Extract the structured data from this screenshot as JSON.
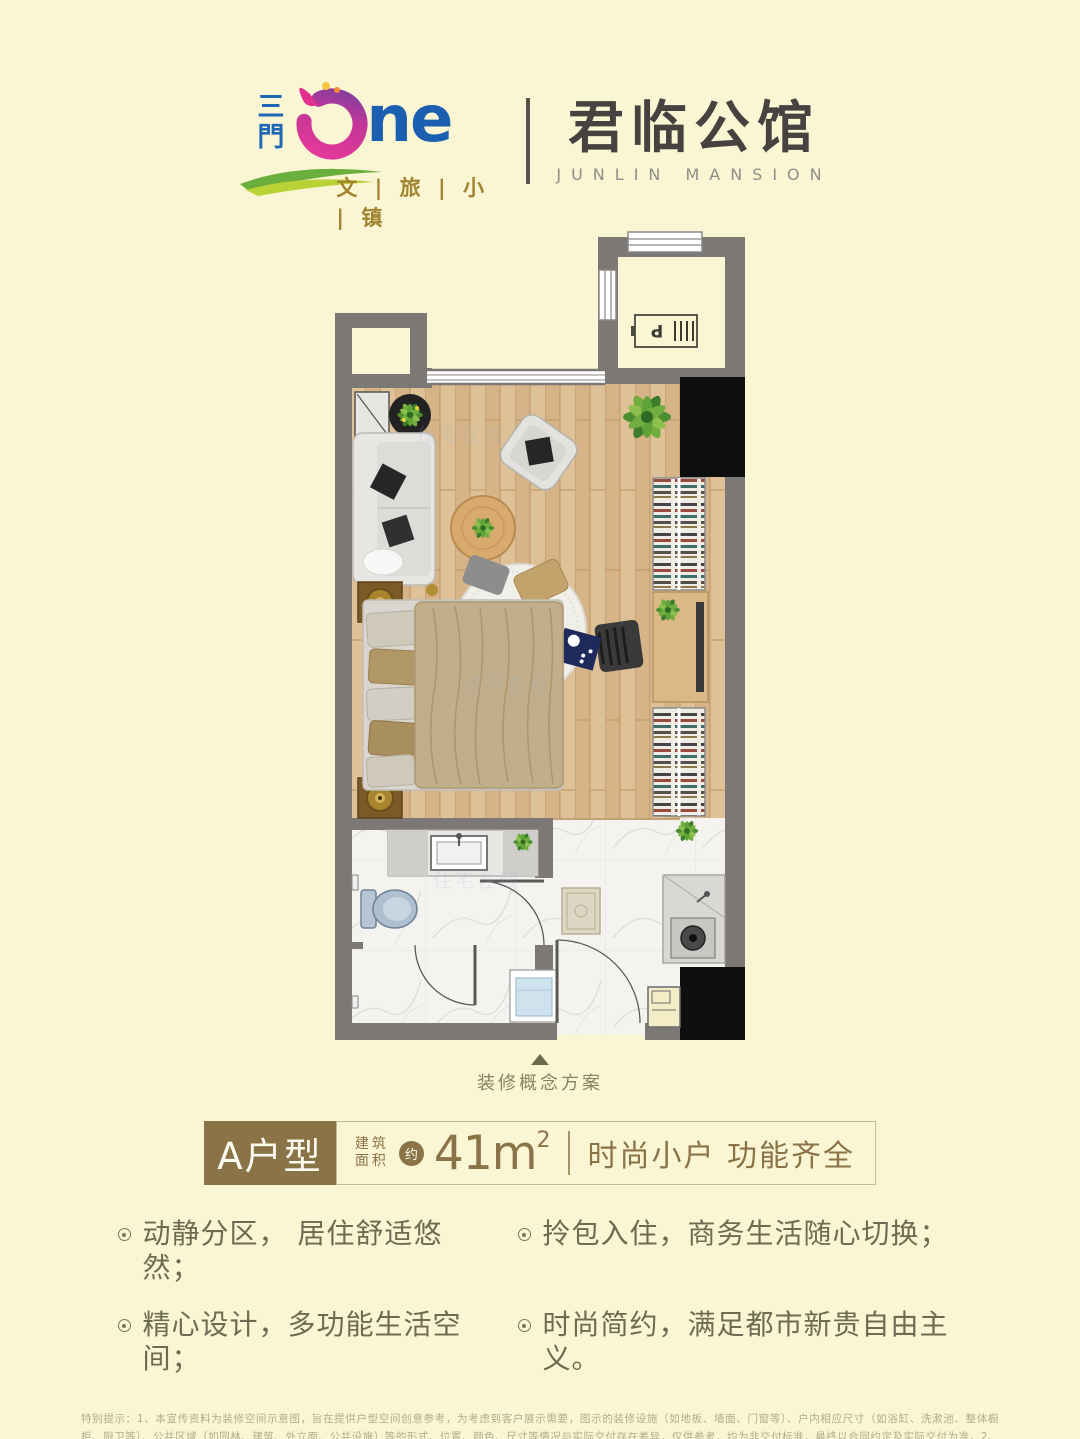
{
  "page": {
    "background": "#faf5d3"
  },
  "header": {
    "vertical_name": "三門",
    "one_suffix": "ne",
    "subtitle": "文 | 旅 | 小 | 镇",
    "name_cn": "君临公馆",
    "name_en": "JUNLIN MANSION",
    "colors": {
      "blue": "#1b5fb0",
      "pink": "#e0318f",
      "purple": "#7a3fa0",
      "green": "#6aae3c",
      "lime": "#b9d234",
      "gold": "#a1842f",
      "dark": "#454240"
    }
  },
  "floorplan": {
    "caption": "装修概念方案",
    "ac_unit_label": "P",
    "watermark": "住宅在线",
    "colors": {
      "wall": "#7b7876",
      "wood": "#d6b487",
      "marble": "#f4f3f0"
    }
  },
  "unit": {
    "type_label": "A户型",
    "area_label_line1": "建筑",
    "area_label_line2": "面积",
    "approx_badge": "约",
    "area_value": "41m",
    "area_superscript": "2",
    "tagline": "时尚小户 功能齐全",
    "accent_color": "#8a7347"
  },
  "features": [
    "动静分区， 居住舒适悠然；",
    "精心设计，多功能生活空间；",
    "拎包入住，商务生活随心切换；",
    "时尚简约，满足都市新贵自由主义。"
  ],
  "disclaimer": "特别提示：1、本宣传资料为装修空间示意图，旨在提供户型空间创意参考，为考虑到客户展示需要，图示的装修设施（如地板、墙面、门窗等）、户内相应尺寸（如浴缸、洗漱池、整体橱柜、厨卫等）、公共区域（如园林、建筑、外立面、公共设施）等的形式、位置、颜色、尺寸等情况与实际交付存在差异，仅供参考，均为非交付标准，最终以合同约定及实际交付为准。2、本宣传资料所展示范围内可移动装饰设施（如家具、电器、装饰品等）不属于交付范围的设施，均为非交付项目，交付时均不存在。3、相同户型单位因楼栋、楼层、单元等差别，结构布局、层高、朝向等可能存在差异，最终以实际交付为准。4、本宣传资料发布于2019年8月，仅供参考，本公司保留对本宣传资料进行修改、修正、补充的权利，恕不另行通知，敬请垂询营销置业顾问资料。"
}
